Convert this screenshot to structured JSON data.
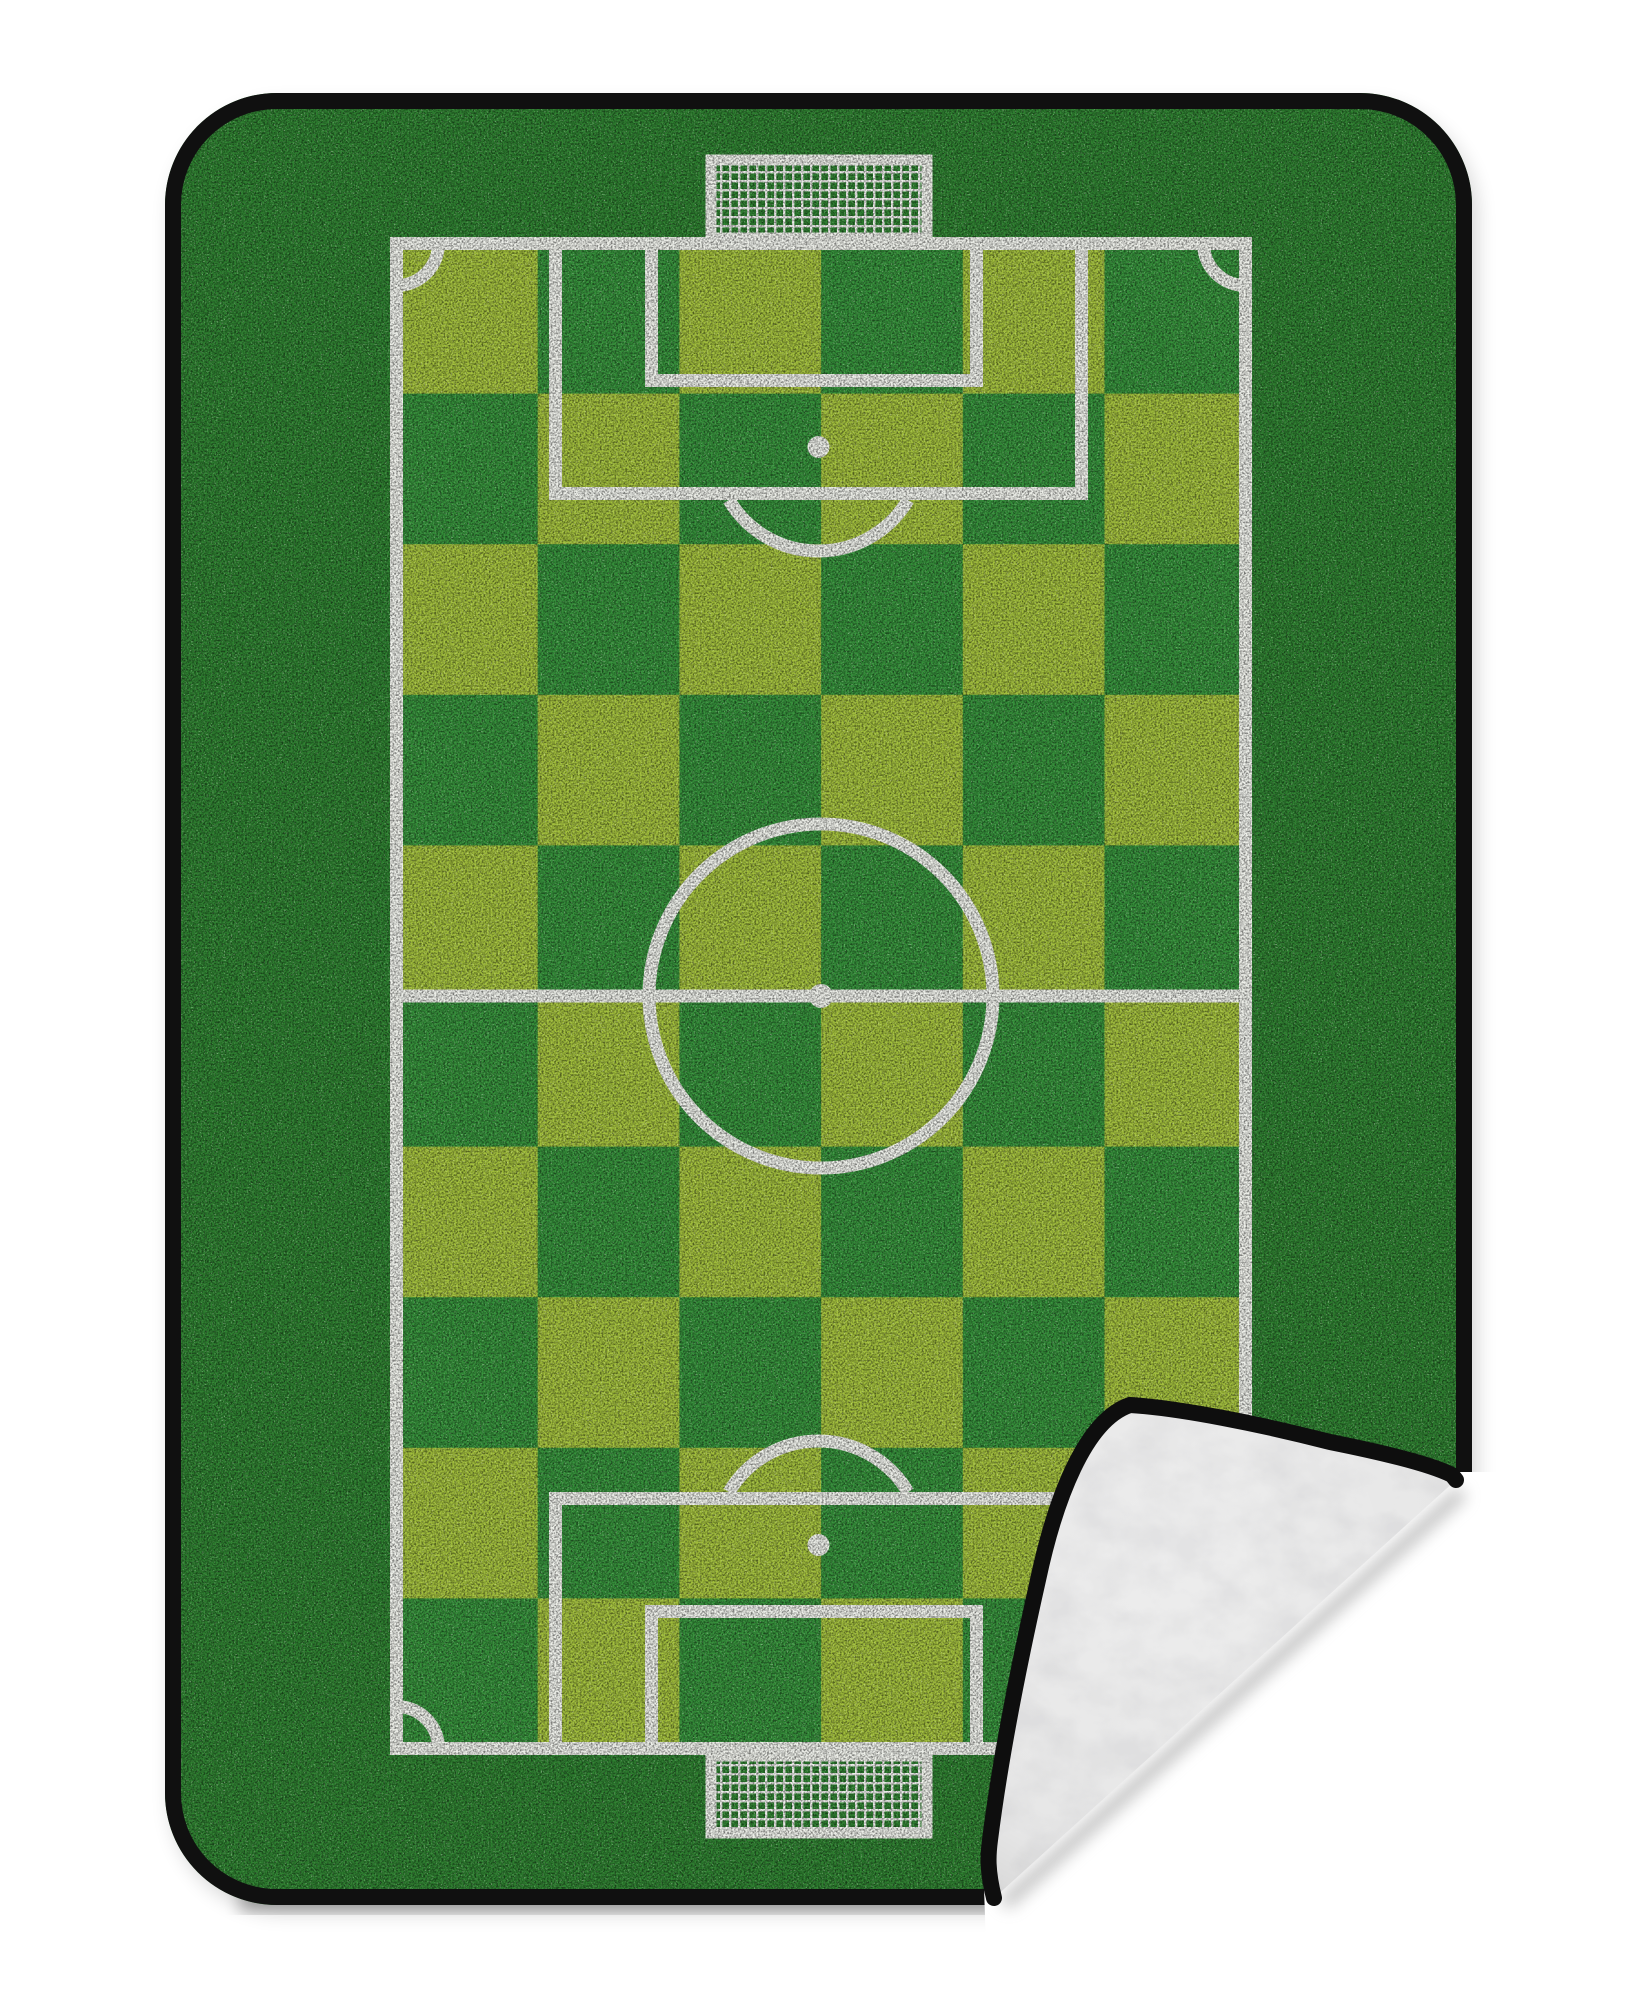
{
  "scene": {
    "kind": "product-photo",
    "subject": "soccer-field fleece blanket with folded corner showing sherpa underside",
    "background_color": "#ffffff"
  },
  "blanket": {
    "border_color": "#101010",
    "grass_color": "#2e8030",
    "shadow_color": "#000000"
  },
  "field": {
    "line_color": "#edefe9",
    "line_width": 13,
    "checker": {
      "cols": 6,
      "rows": 10,
      "x": 396,
      "y": 243,
      "cell_width": 141.7,
      "cell_height": 150.6,
      "light_color": "#a2bf3c",
      "dark_color": "#35903a"
    },
    "markings": [
      "boundary",
      "halfway-line",
      "center-circle",
      "center-spot",
      "penalty-area-top",
      "goal-area-top",
      "penalty-spot-top",
      "penalty-arc-top",
      "penalty-area-bottom",
      "goal-area-bottom",
      "penalty-spot-bottom",
      "penalty-arc-bottom",
      "corner-arc-top-left",
      "corner-arc-top-right",
      "corner-arc-bottom-left",
      "corner-arc-bottom-right"
    ]
  },
  "goals": {
    "net_color": "#eef0ec",
    "positions": [
      "top-center",
      "bottom-center"
    ]
  },
  "fold": {
    "fleece_color": "#ededed",
    "trim_color": "#0e0e0e",
    "shadow_color": "#8f8f8f",
    "position": "bottom-right"
  }
}
